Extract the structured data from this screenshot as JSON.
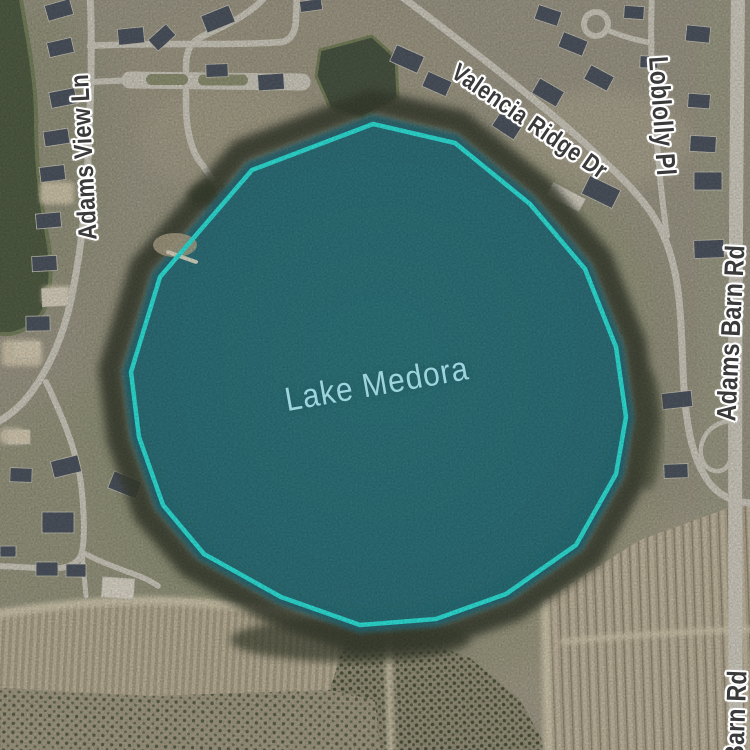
{
  "map": {
    "kind": "satellite-map",
    "lake": {
      "text": "Lake Medora"
    },
    "streets": [
      {
        "id": "valencia-ridge-dr",
        "text": "Valencia Ridge Dr"
      },
      {
        "id": "loblolly-pl",
        "text": "Loblolly Pl"
      },
      {
        "id": "adams-view-ln",
        "text": "Adams View Ln"
      },
      {
        "id": "adams-barn-rd",
        "text": "Adams Barn Rd"
      },
      {
        "id": "adams-barn-rd-south",
        "text": "Barn Rd"
      }
    ],
    "colors": {
      "water": "#2d6b74",
      "selection_outline": "#2fe3d9",
      "terrain": "#9c9786",
      "road": "#cdc9bd",
      "tree_ring": "#3b4130",
      "street_label": "#3a3a3a",
      "street_label_halo": "#ffffff",
      "lake_label": "#9ed4de"
    }
  }
}
